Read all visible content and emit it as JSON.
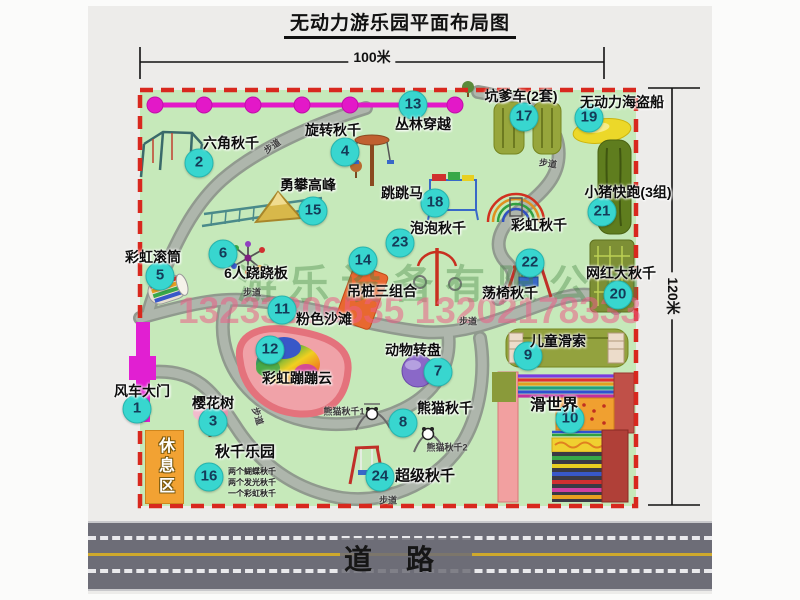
{
  "title": "无动力游乐园平面布局图",
  "dimensions": {
    "width_label": "100米",
    "height_label": "120米"
  },
  "road": {
    "label": "道路"
  },
  "watermark": {
    "company": "游乐设备有限公司",
    "phone": "13233806535 13202178333"
  },
  "map": {
    "rest_area": "休息区",
    "attractions": [
      {
        "num": "1",
        "name": "风车大门",
        "badge": [
          137,
          409
        ],
        "label": [
          142,
          391
        ]
      },
      {
        "num": "2",
        "name": "六角秋千",
        "badge": [
          199,
          163
        ],
        "label": [
          231,
          143
        ]
      },
      {
        "num": "3",
        "name": "樱花树",
        "badge": [
          213,
          422
        ],
        "label": [
          213,
          403
        ]
      },
      {
        "num": "4",
        "name": "旋转秋千",
        "badge": [
          345,
          152
        ],
        "label": [
          333,
          130
        ]
      },
      {
        "num": "5",
        "name": "彩虹滚筒",
        "badge": [
          160,
          276
        ],
        "label": [
          153,
          257
        ]
      },
      {
        "num": "6",
        "name": "6人跷跷板",
        "badge": [
          223,
          254
        ],
        "label": [
          256,
          273
        ]
      },
      {
        "num": "7",
        "name": "动物转盘",
        "badge": [
          438,
          372
        ],
        "label": [
          413,
          350
        ]
      },
      {
        "num": "8",
        "name": "熊猫秋千",
        "badge": [
          403,
          423
        ],
        "label": [
          445,
          408
        ]
      },
      {
        "num": "9",
        "name": "儿童滑索",
        "badge": [
          528,
          356
        ],
        "label": [
          558,
          341
        ]
      },
      {
        "num": "10",
        "name": "滑世界",
        "badge": [
          570,
          419
        ],
        "label": [
          554,
          403
        ],
        "size": 16
      },
      {
        "num": "11",
        "name": "粉色沙滩",
        "badge": [
          282,
          310
        ],
        "label": [
          324,
          319
        ]
      },
      {
        "num": "12",
        "name": "彩虹蹦蹦云",
        "badge": [
          270,
          350
        ],
        "label": [
          297,
          378
        ]
      },
      {
        "num": "13",
        "name": "丛林穿越",
        "badge": [
          413,
          105
        ],
        "label": [
          423,
          124
        ]
      },
      {
        "num": "14",
        "name": "吊桩三组合",
        "badge": [
          363,
          261
        ],
        "label": [
          382,
          291
        ]
      },
      {
        "num": "15",
        "name": "勇攀高峰",
        "badge": [
          313,
          211
        ],
        "label": [
          308,
          185
        ]
      },
      {
        "num": "16",
        "name": "秋千乐园",
        "badge": [
          209,
          477
        ],
        "label": [
          245,
          451
        ],
        "size": 15
      },
      {
        "num": "17",
        "name": "坑爹车(2套)",
        "badge": [
          524,
          117
        ],
        "label": [
          521,
          96
        ]
      },
      {
        "num": "18",
        "name": "跳跳马",
        "badge": [
          435,
          203
        ],
        "label": [
          402,
          193
        ]
      },
      {
        "num": "19",
        "name": "无动力海盗船",
        "badge": [
          589,
          118
        ],
        "label": [
          622,
          102
        ]
      },
      {
        "num": "20",
        "name": "网红大秋千",
        "badge": [
          618,
          295
        ],
        "label": [
          621,
          273
        ]
      },
      {
        "num": "21",
        "name": "小猪快跑(3组)",
        "badge": [
          602,
          212
        ],
        "label": [
          628,
          192
        ]
      },
      {
        "num": "22",
        "name": "荡椅秋千",
        "badge": [
          530,
          263
        ],
        "label": [
          510,
          293
        ]
      },
      {
        "num": "23",
        "name": "泡泡秋千",
        "badge": [
          400,
          243
        ],
        "label": [
          438,
          228
        ]
      },
      {
        "num": "24",
        "name": "超级秋千",
        "badge": [
          380,
          477
        ],
        "label": [
          425,
          475
        ],
        "size": 15
      },
      {
        "num": null,
        "name": "彩虹秋千",
        "label": [
          539,
          225
        ]
      }
    ],
    "small_labels": [
      {
        "text": "步道",
        "pos": [
          272,
          146
        ],
        "rot": -35
      },
      {
        "text": "步道",
        "pos": [
          548,
          163
        ],
        "rot": 8
      },
      {
        "text": "步道",
        "pos": [
          252,
          292
        ],
        "rot": 0
      },
      {
        "text": "步道",
        "pos": [
          468,
          321
        ],
        "rot": 0
      },
      {
        "text": "步道",
        "pos": [
          388,
          500
        ],
        "rot": 0
      },
      {
        "text": "步道",
        "pos": [
          258,
          416
        ],
        "rot": 72
      },
      {
        "text": "熊猫秋千1",
        "pos": [
          344,
          411
        ],
        "rot": 0
      },
      {
        "text": "熊猫秋千2",
        "pos": [
          447,
          447
        ],
        "rot": 0
      }
    ],
    "swing_park_notes": [
      "两个蝴蝶秋千",
      "两个发光秋千",
      "一个彩虹秋千"
    ]
  },
  "colors": {
    "map_green": "#c6e9ba",
    "border_red": "#d8281e",
    "badge_cyan": "#38d6cf",
    "chain_magenta": "#e318c8",
    "gate_magenta": "#e11fd2",
    "rest_orange": "#f2a233",
    "road_gray": "#6d6d77",
    "beach_pink": "#f0a2a8"
  }
}
